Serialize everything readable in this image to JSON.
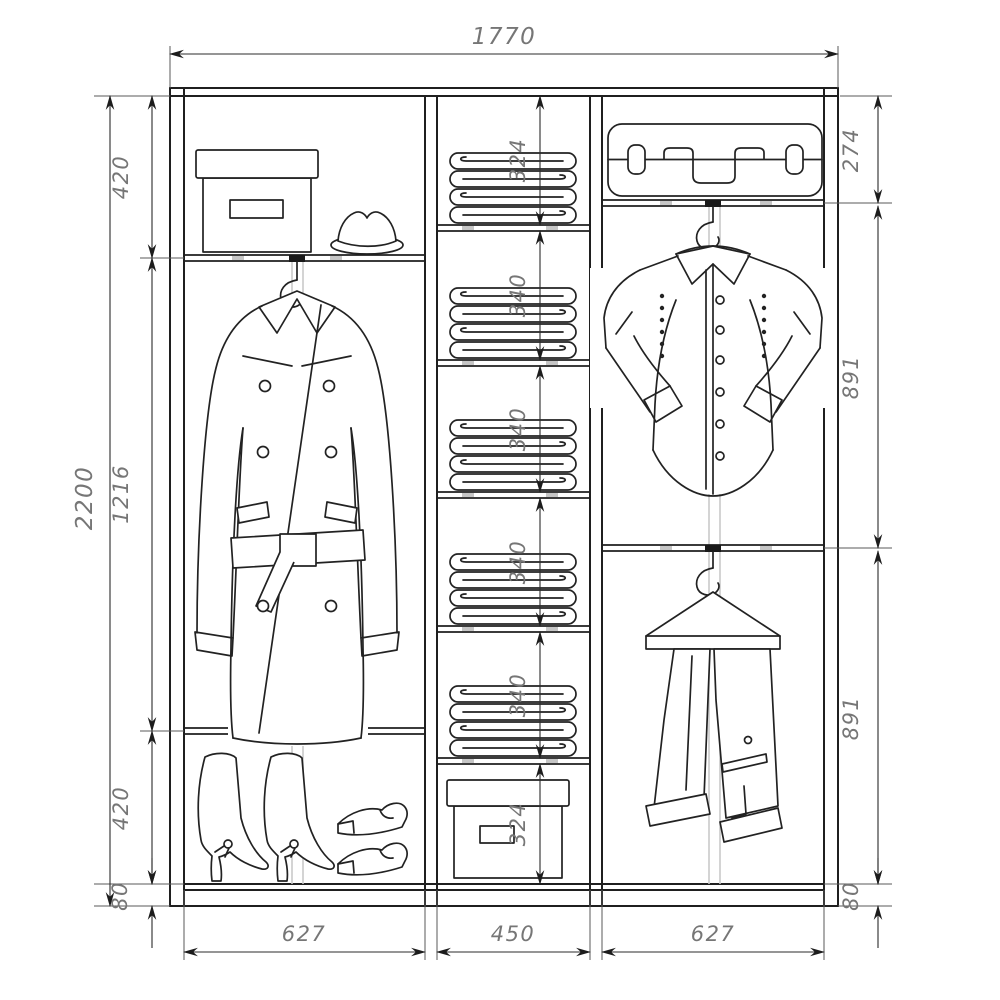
{
  "drawing": {
    "kind": "wardrobe-interior-dimension-drawing",
    "dimensions": {
      "overall_width": "1770",
      "overall_height": "2200",
      "left_section": {
        "top": "420",
        "middle": "1216",
        "bottom": "420",
        "plinth": "80"
      },
      "middle_shelves": [
        "324",
        "340",
        "340",
        "340",
        "340",
        "324"
      ],
      "right_section": {
        "top": "274",
        "upper": "891",
        "lower": "891",
        "plinth": "80"
      },
      "section_widths": [
        "627",
        "450",
        "627"
      ]
    },
    "icons": [
      "storage-box-icon",
      "hat-icon",
      "coat-icon",
      "boots-icon",
      "shoes-icon",
      "towel-stack-icon",
      "linen-box-icon",
      "suitcase-icon",
      "shirt-icon",
      "hanger-icon",
      "trousers-icon"
    ],
    "colors": {
      "line": "#1f1f1f",
      "dimension_text": "#767676",
      "background": "#ffffff",
      "hardware_gray": "#c9c9c9"
    }
  }
}
